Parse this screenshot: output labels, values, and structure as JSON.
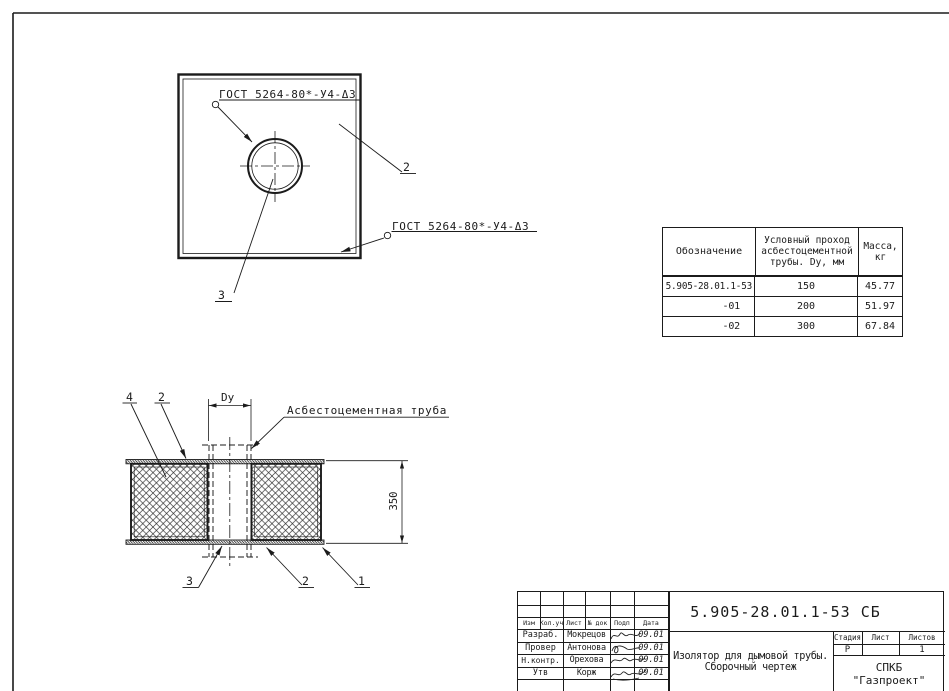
{
  "top_view": {
    "weld_note_1": "ГОСТ 5264-80*-У4-Δ3",
    "weld_note_2": "ГОСТ 5264-80*-У4-Δ3",
    "callout_plate": "2",
    "callout_hole": "3"
  },
  "section_view": {
    "callout_insulation": "4",
    "callout_plate_top": "2",
    "dim_bore": "Dy",
    "pipe_label": "Асбестоцементная труба",
    "dim_height": "350",
    "callout_sleeve": "3",
    "callout_plate_bottom": "2",
    "callout_casing": "1"
  },
  "spec_table": {
    "col_designation": "Обозначение",
    "col_bore": "Условный проход\nасбестоцементной\nтрубы. Dy, мм",
    "col_mass": "Масса,\nкг",
    "rows": [
      {
        "designation": "5.905-28.01.1-53",
        "bore": "150",
        "mass": "45.77"
      },
      {
        "designation": "-01",
        "bore": "200",
        "mass": "51.97"
      },
      {
        "designation": "-02",
        "bore": "300",
        "mass": "67.84"
      }
    ]
  },
  "title_block": {
    "designation": "5.905-28.01.1-53 СБ",
    "doc_name_1": "Изолятор для дымовой трубы.",
    "doc_name_2": "Сборочный чертеж",
    "org_1": "СПКБ",
    "org_2": "\"Газпроект\"",
    "col_izm": "Изм",
    "col_koluch": "Кол.уч",
    "col_list": "Лист",
    "col_ndok": "№ док",
    "col_podp": "Подп",
    "col_data": "Дата",
    "rows": [
      {
        "role": "Разраб.",
        "name": "Мокрецов",
        "date": "09.01"
      },
      {
        "role": "Провер",
        "name": "Антонова",
        "date": "09.01"
      },
      {
        "role": "Н.контр.",
        "name": "Орехова",
        "date": "09.01"
      },
      {
        "role": "Утв",
        "name": "Корж",
        "date": "09.01"
      }
    ],
    "stage_label": "Стадия",
    "sheet_label": "Лист",
    "sheets_label": "Листов",
    "stage_value": "Р",
    "sheet_value": "",
    "sheets_value": "1"
  }
}
